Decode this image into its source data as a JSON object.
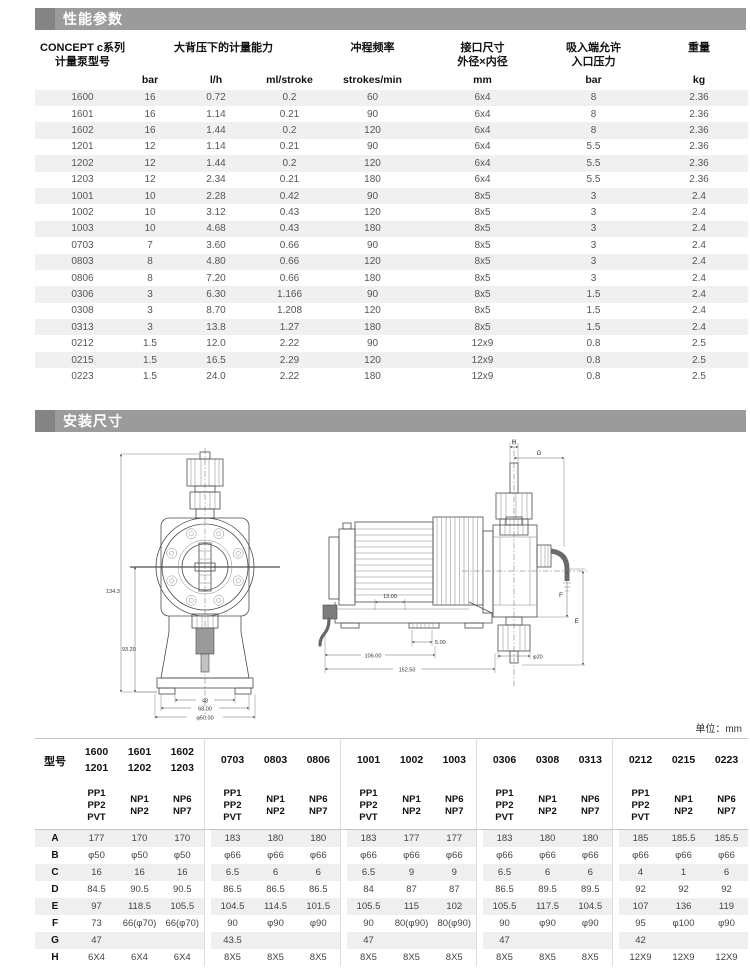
{
  "sections": {
    "performance": {
      "title": "性能参数"
    },
    "dimensions": {
      "title": "安装尺寸"
    }
  },
  "performance_table": {
    "header": {
      "model_line1": "CONCEPT c系列",
      "model_line2": "计量泵型号",
      "capacity_title": "大背压下的计量能力",
      "capacity_units": [
        "bar",
        "l/h",
        "ml/stroke"
      ],
      "freq_title": "冲程频率",
      "freq_unit": "strokes/min",
      "port_title_line1": "接口尺寸",
      "port_title_line2": "外径×内径",
      "port_unit": "mm",
      "suction_title_line1": "吸入端允许",
      "suction_title_line2": "入口压力",
      "suction_unit": "bar",
      "weight_title": "重量",
      "weight_unit": "kg"
    },
    "rows": [
      [
        "1600",
        "16",
        "0.72",
        "0.2",
        "60",
        "6x4",
        "8",
        "2.36"
      ],
      [
        "1601",
        "16",
        "1.14",
        "0.21",
        "90",
        "6x4",
        "8",
        "2.36"
      ],
      [
        "1602",
        "16",
        "1.44",
        "0.2",
        "120",
        "6x4",
        "8",
        "2.36"
      ],
      [
        "1201",
        "12",
        "1.14",
        "0.21",
        "90",
        "6x4",
        "5.5",
        "2.36"
      ],
      [
        "1202",
        "12",
        "1.44",
        "0.2",
        "120",
        "6x4",
        "5.5",
        "2.36"
      ],
      [
        "1203",
        "12",
        "2.34",
        "0.21",
        "180",
        "6x4",
        "5.5",
        "2.36"
      ],
      [
        "1001",
        "10",
        "2.28",
        "0.42",
        "90",
        "8x5",
        "3",
        "2.4"
      ],
      [
        "1002",
        "10",
        "3.12",
        "0.43",
        "120",
        "8x5",
        "3",
        "2.4"
      ],
      [
        "1003",
        "10",
        "4.68",
        "0.43",
        "180",
        "8x5",
        "3",
        "2.4"
      ],
      [
        "0703",
        "7",
        "3.60",
        "0.66",
        "90",
        "8x5",
        "3",
        "2.4"
      ],
      [
        "0803",
        "8",
        "4.80",
        "0.66",
        "120",
        "8x5",
        "3",
        "2.4"
      ],
      [
        "0806",
        "8",
        "7.20",
        "0.66",
        "180",
        "8x5",
        "3",
        "2.4"
      ],
      [
        "0306",
        "3",
        "6.30",
        "1.166",
        "90",
        "8x5",
        "1.5",
        "2.4"
      ],
      [
        "0308",
        "3",
        "8.70",
        "1.208",
        "120",
        "8x5",
        "1.5",
        "2.4"
      ],
      [
        "0313",
        "3",
        "13.8",
        "1.27",
        "180",
        "8x5",
        "1.5",
        "2.4"
      ],
      [
        "0212",
        "1.5",
        "12.0",
        "2.22",
        "90",
        "12x9",
        "0.8",
        "2.5"
      ],
      [
        "0215",
        "1.5",
        "16.5",
        "2.29",
        "120",
        "12x9",
        "0.8",
        "2.5"
      ],
      [
        "0223",
        "1.5",
        "24.0",
        "2.22",
        "180",
        "12x9",
        "0.8",
        "2.5"
      ]
    ]
  },
  "drawings": {
    "front_view": {
      "height_total": "134.3",
      "height_center": "93.20",
      "width_inner": "48",
      "width_mid": "68.00",
      "width_outer": "φ50.00"
    },
    "side_view": {
      "h": "H",
      "g": "G",
      "f": "F",
      "e": "E",
      "d13": "13.00",
      "d5": "5.00",
      "d106": "106.00",
      "d152": "152.50",
      "phi20": "φ20"
    }
  },
  "dimension_table": {
    "unit_note": "单位：mm",
    "model_label": "型号",
    "groups": [
      {
        "models": [
          "1600\n1201",
          "1601\n1202",
          "1602\n1203"
        ],
        "materials": [
          "PP1\nPP2\nPVT",
          "NP1\nNP2",
          "NP6\nNP7"
        ]
      },
      {
        "models": [
          "0703",
          "0803",
          "0806"
        ],
        "materials": [
          "PP1\nPP2\nPVT",
          "NP1\nNP2",
          "NP6\nNP7"
        ]
      },
      {
        "models": [
          "1001",
          "1002",
          "1003"
        ],
        "materials": [
          "PP1\nPP2\nPVT",
          "NP1\nNP2",
          "NP6\nNP7"
        ]
      },
      {
        "models": [
          "0306",
          "0308",
          "0313"
        ],
        "materials": [
          "PP1\nPP2\nPVT",
          "NP1\nNP2",
          "NP6\nNP7"
        ]
      },
      {
        "models": [
          "0212",
          "0215",
          "0223"
        ],
        "materials": [
          "PP1\nPP2\nPVT",
          "NP1\nNP2",
          "NP6\nNP7"
        ]
      }
    ],
    "rows": [
      {
        "label": "A",
        "values": [
          [
            "177",
            "170",
            "170"
          ],
          [
            "183",
            "180",
            "180"
          ],
          [
            "183",
            "177",
            "177"
          ],
          [
            "183",
            "180",
            "180"
          ],
          [
            "185",
            "185.5",
            "185.5"
          ]
        ]
      },
      {
        "label": "B",
        "values": [
          [
            "φ50",
            "φ50",
            "φ50"
          ],
          [
            "φ66",
            "φ66",
            "φ66"
          ],
          [
            "φ66",
            "φ66",
            "φ66"
          ],
          [
            "φ66",
            "φ66",
            "φ66"
          ],
          [
            "φ66",
            "φ66",
            "φ66"
          ]
        ]
      },
      {
        "label": "C",
        "values": [
          [
            "16",
            "16",
            "16"
          ],
          [
            "6.5",
            "6",
            "6"
          ],
          [
            "6.5",
            "9",
            "9"
          ],
          [
            "6.5",
            "6",
            "6"
          ],
          [
            "4",
            "1",
            "6"
          ]
        ]
      },
      {
        "label": "D",
        "values": [
          [
            "84.5",
            "90.5",
            "90.5"
          ],
          [
            "86.5",
            "86.5",
            "86.5"
          ],
          [
            "84",
            "87",
            "87"
          ],
          [
            "86.5",
            "89.5",
            "89.5"
          ],
          [
            "92",
            "92",
            "92"
          ]
        ]
      },
      {
        "label": "E",
        "values": [
          [
            "97",
            "118.5",
            "105.5"
          ],
          [
            "104.5",
            "114.5",
            "101.5"
          ],
          [
            "105.5",
            "115",
            "102"
          ],
          [
            "105.5",
            "117.5",
            "104.5"
          ],
          [
            "107",
            "136",
            "119"
          ]
        ]
      },
      {
        "label": "F",
        "values": [
          [
            "73",
            "66(φ70)",
            "66(φ70)"
          ],
          [
            "90",
            "φ90",
            "φ90"
          ],
          [
            "90",
            "80(φ90)",
            "80(φ90)"
          ],
          [
            "90",
            "φ90",
            "φ90"
          ],
          [
            "95",
            "φ100",
            "φ90"
          ]
        ]
      },
      {
        "label": "G",
        "values": [
          [
            "47",
            "",
            ""
          ],
          [
            "43.5",
            "",
            ""
          ],
          [
            "47",
            "",
            ""
          ],
          [
            "47",
            "",
            ""
          ],
          [
            "42",
            "",
            ""
          ]
        ]
      },
      {
        "label": "H",
        "values": [
          [
            "6X4",
            "6X4",
            "6X4"
          ],
          [
            "8X5",
            "8X5",
            "8X5"
          ],
          [
            "8X5",
            "8X5",
            "8X5"
          ],
          [
            "8X5",
            "8X5",
            "8X5"
          ],
          [
            "12X9",
            "12X9",
            "12X9"
          ]
        ]
      }
    ]
  }
}
